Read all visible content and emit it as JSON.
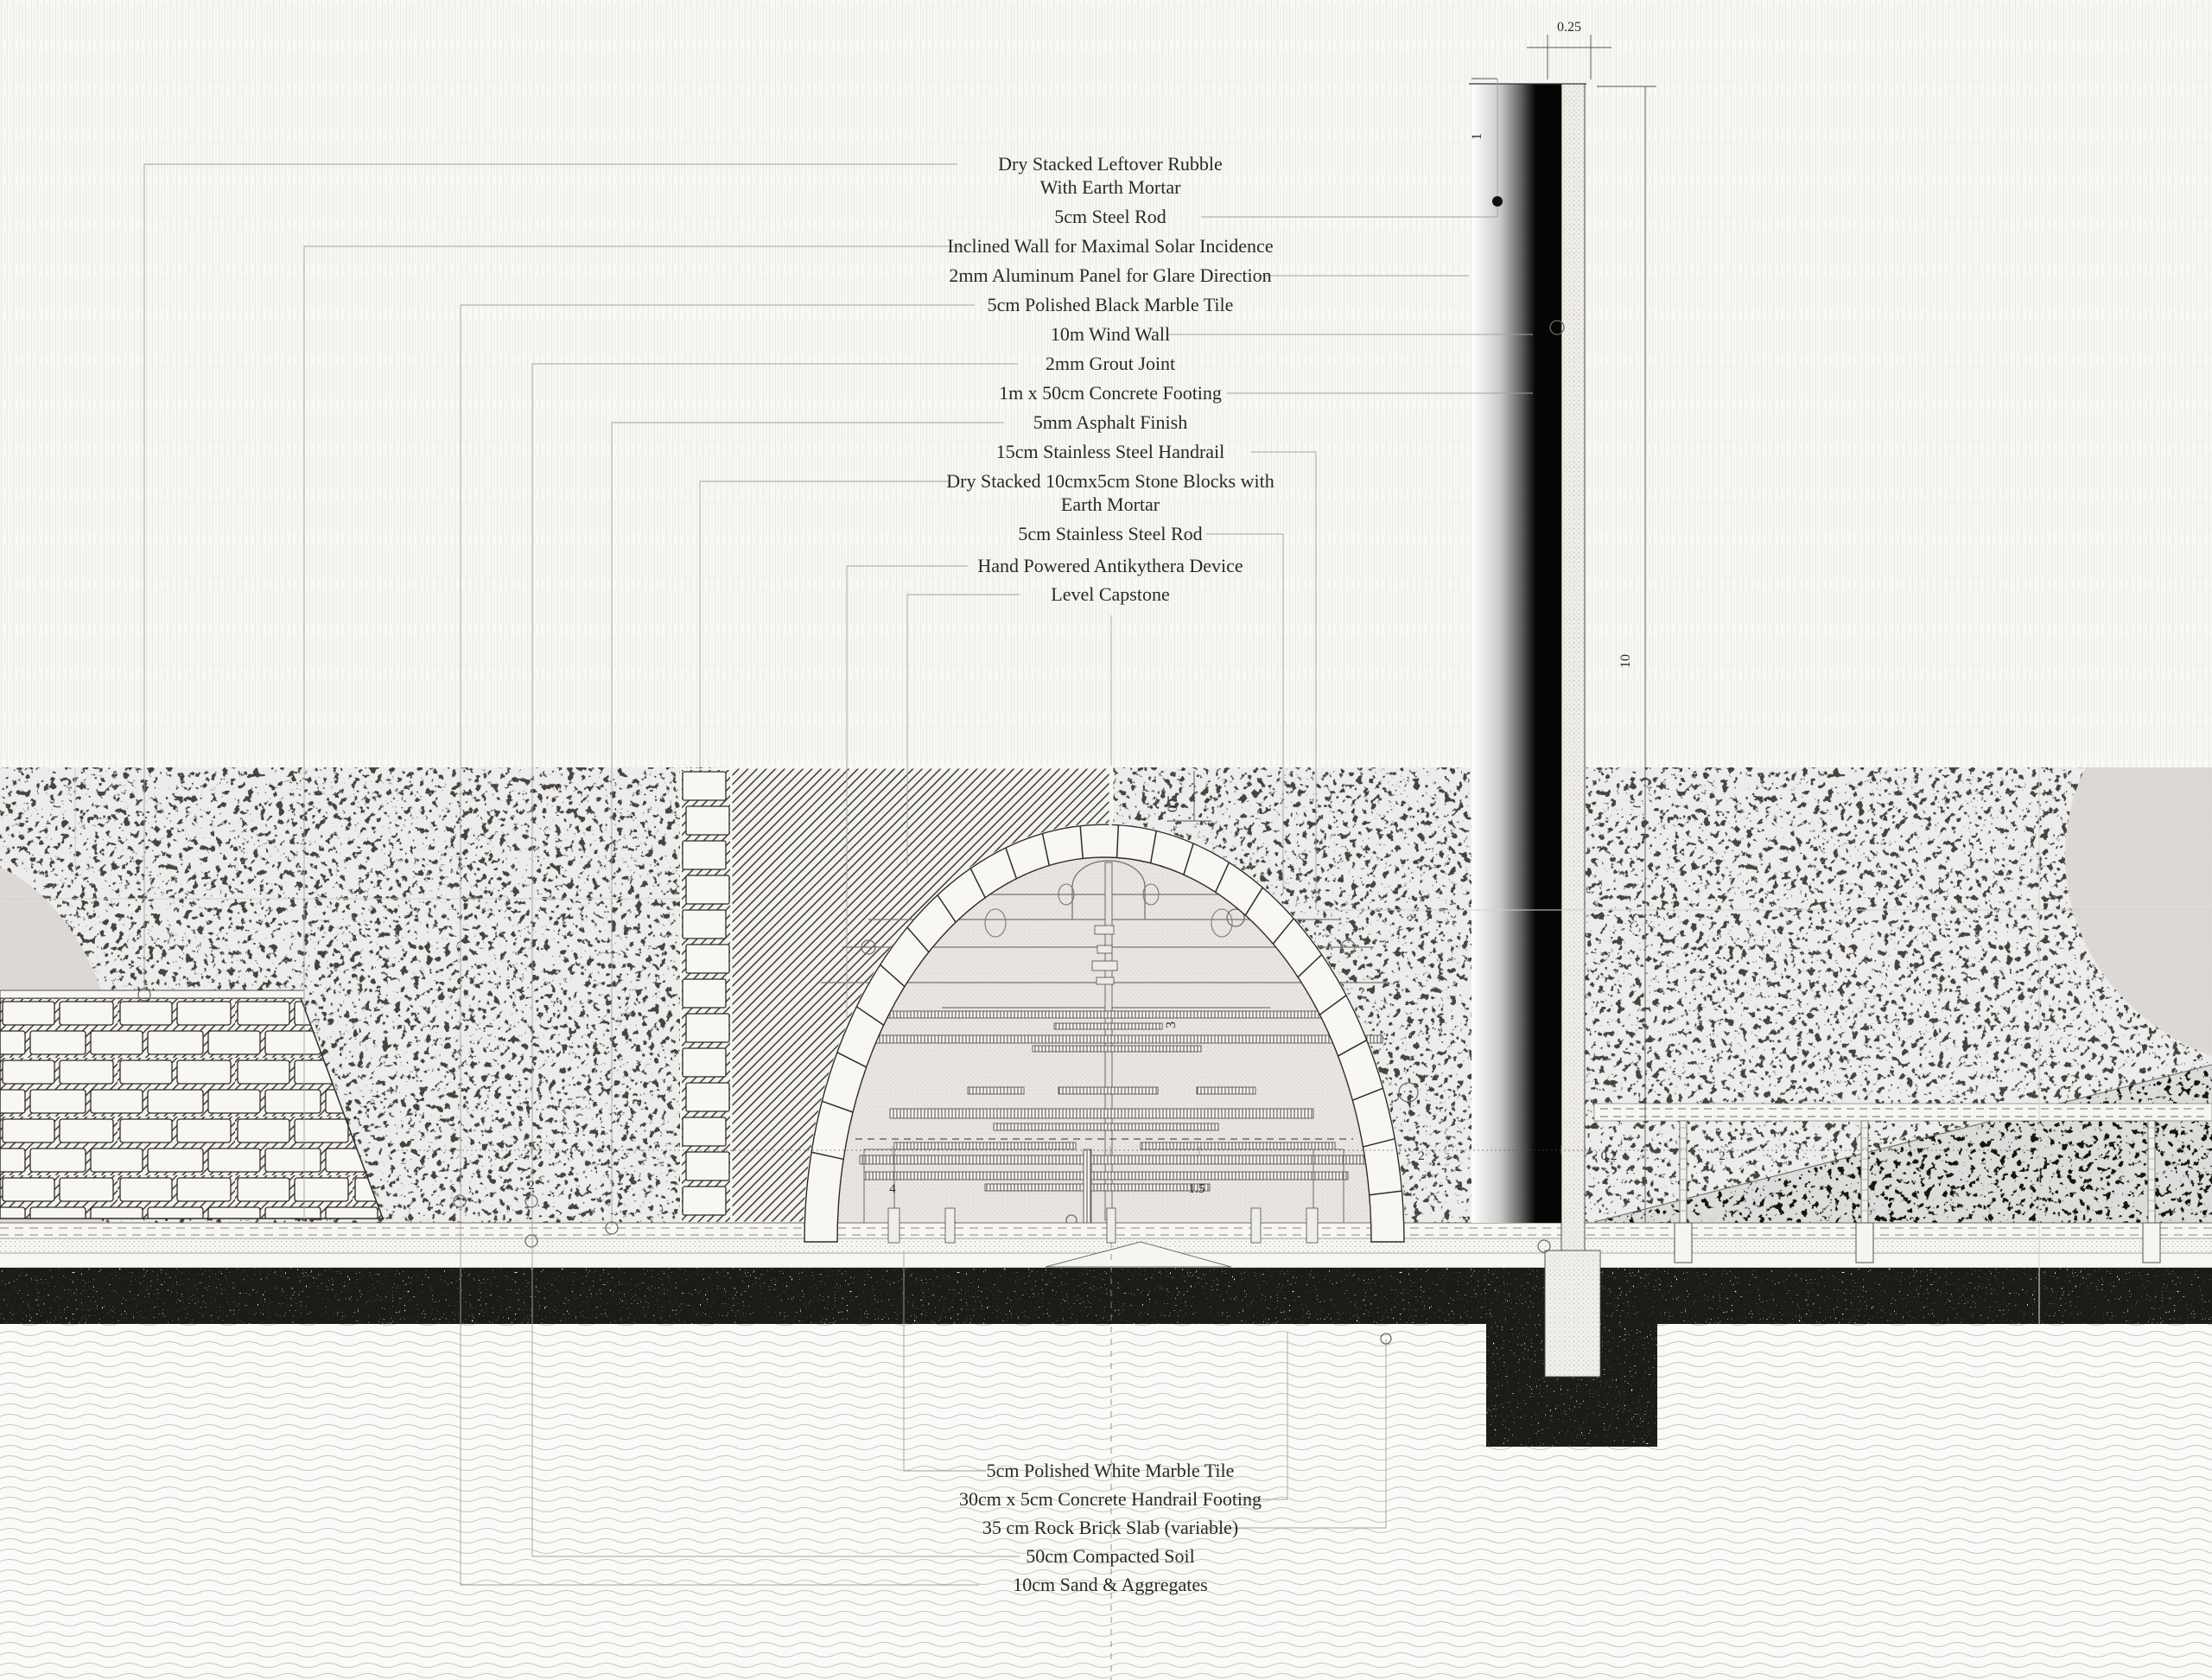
{
  "drawing": {
    "callouts_top": [
      {
        "lines": [
          "Dry Stacked Leftover Rubble",
          "With Earth Mortar"
        ]
      },
      {
        "lines": [
          "5cm Steel Rod"
        ]
      },
      {
        "lines": [
          "Inclined Wall for  Maximal Solar Incidence"
        ]
      },
      {
        "lines": [
          "2mm Aluminum Panel for Glare Direction"
        ]
      },
      {
        "lines": [
          "5cm Polished Black Marble Tile"
        ]
      },
      {
        "lines": [
          "10m Wind Wall"
        ]
      },
      {
        "lines": [
          "2mm Grout Joint"
        ]
      },
      {
        "lines": [
          "1m x 50cm Concrete Footing"
        ]
      },
      {
        "lines": [
          "5mm Asphalt Finish"
        ]
      },
      {
        "lines": [
          "15cm Stainless Steel Handrail"
        ]
      },
      {
        "lines": [
          "Dry Stacked 10cmx5cm Stone Blocks with",
          "Earth Mortar"
        ]
      },
      {
        "lines": [
          "5cm Stainless Steel Rod"
        ]
      },
      {
        "lines": [
          "Hand Powered Antikythera Device"
        ]
      },
      {
        "lines": [
          "Level Capstone"
        ]
      }
    ],
    "callouts_bottom": [
      {
        "lines": [
          "5cm Polished White Marble Tile"
        ]
      },
      {
        "lines": [
          "30cm x 5cm Concrete Handrail Footing"
        ]
      },
      {
        "lines": [
          "35 cm Rock Brick Slab (variable)"
        ]
      },
      {
        "lines": [
          "50cm Compacted Soil"
        ]
      },
      {
        "lines": [
          "10cm Sand & Aggregates"
        ]
      }
    ],
    "dimensions": {
      "wall_thickness": "0.25",
      "rod_offset": "1",
      "wall_height": "10",
      "arch_rise": "0.5",
      "arch_half_span": "3",
      "row": [
        "2",
        "4",
        "1.5",
        "2",
        "0.2",
        "2"
      ]
    },
    "colors": {
      "paper": "#f9f8f5",
      "soil_dark": "#48433d",
      "soil_black": "#17140f",
      "wall_black": "#050505",
      "line_gray": "#a5a29c"
    }
  }
}
